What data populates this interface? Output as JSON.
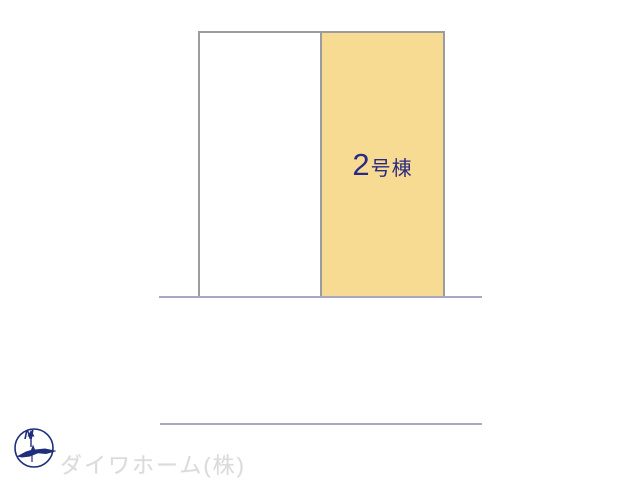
{
  "site_plan": {
    "border_color": "#9c9c9c",
    "road_color": "#a8a8c6",
    "parcels": [
      {
        "id": "parcel-1",
        "fill": "#ffffff"
      },
      {
        "id": "parcel-2",
        "fill": "#f7db92",
        "label_number": "2",
        "label_suffix": "号棟",
        "label_color": "#2a2a82"
      }
    ]
  },
  "compass": {
    "label": "N",
    "color": "#1f2d7b"
  },
  "footer": {
    "company_name": "ダイワホーム(株)",
    "color": "#dbdbdb"
  }
}
